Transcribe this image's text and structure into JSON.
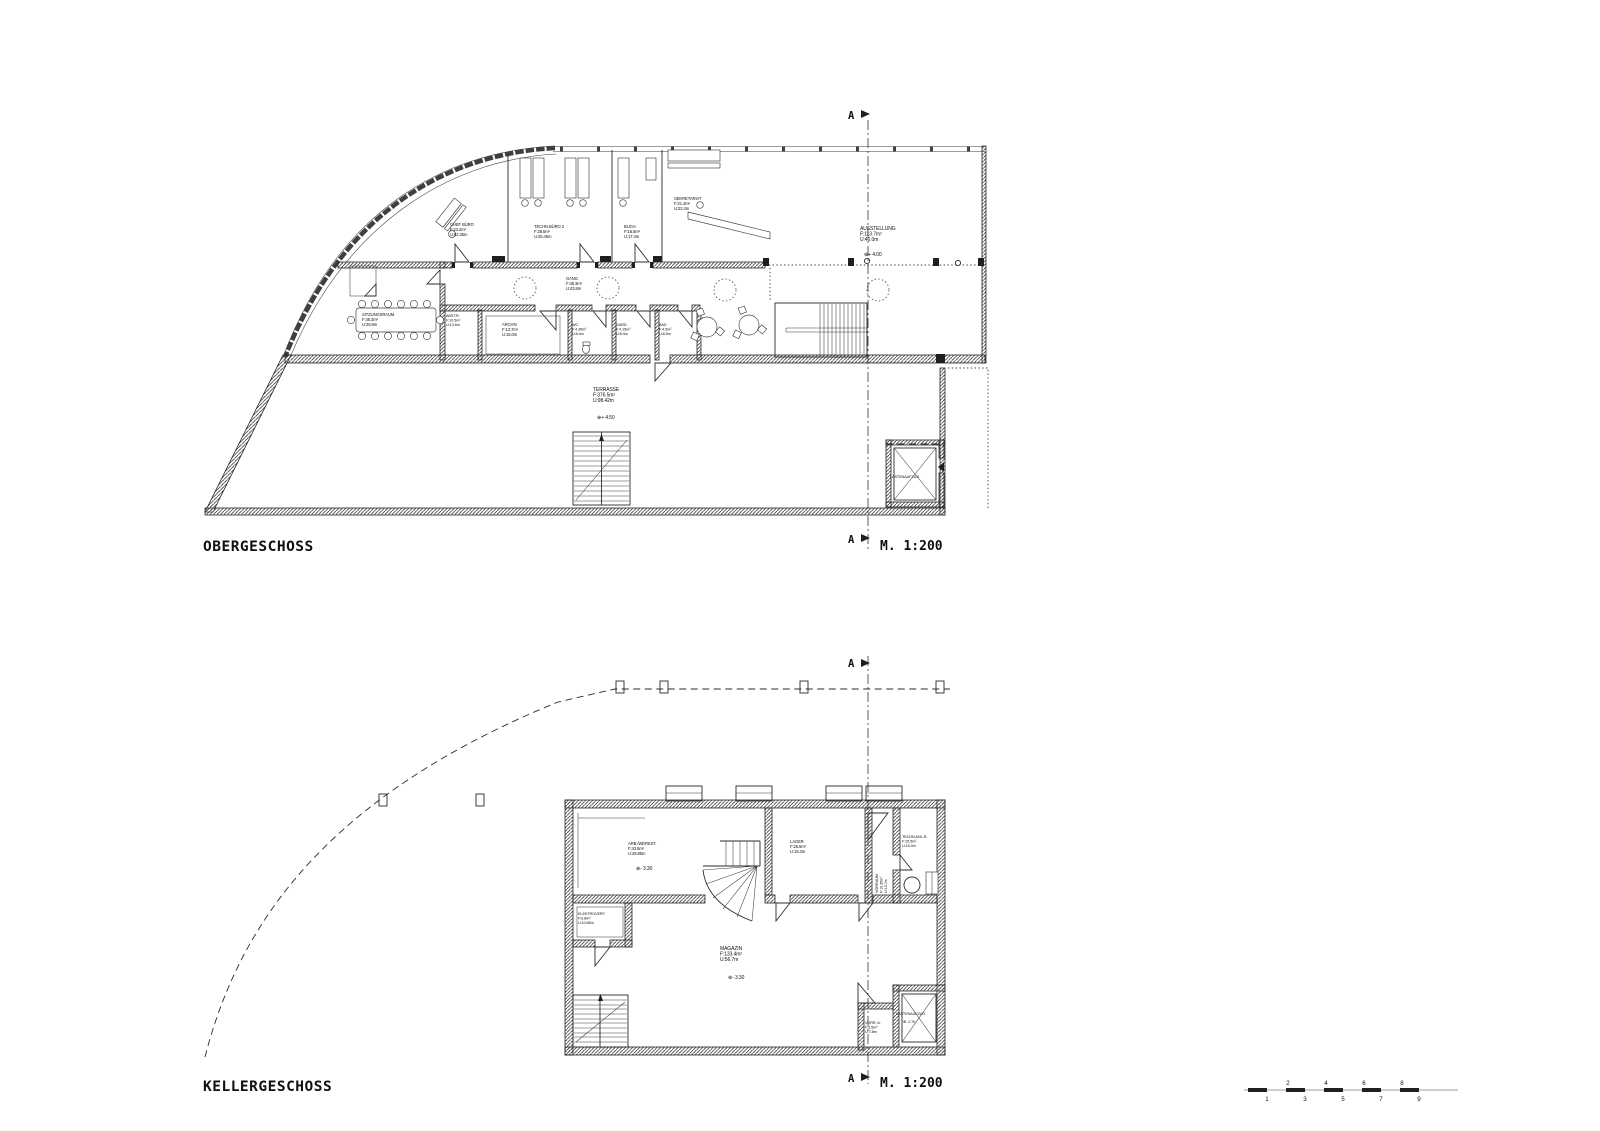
{
  "sheet": {
    "background": "#ffffff",
    "ink": "#1f1f1f"
  },
  "upper": {
    "title": "OBERGESCHOSS",
    "scale": "M. 1:200",
    "section": "A",
    "rooms": {
      "chef": {
        "name": "CHEF BÜRO",
        "a": "F:23.2m²",
        "u": "U:52.35m"
      },
      "techn": {
        "name": "TECHN.BÜRO 2",
        "a": "F:28.5m²",
        "u": "U:25.45m"
      },
      "buch": {
        "name": "BUCH.",
        "a": "F:16.5m²",
        "u": "U:17.4m"
      },
      "sekr": {
        "name": "SEKRETARIAT",
        "a": "F:21.4m²",
        "u": "U:22.4m"
      },
      "ausstellung": {
        "name": "AUSSTELLUNG",
        "a": "F:113.7m²",
        "u": "U:46.0m",
        "lvl": "⊕+ 4.00"
      },
      "gang": {
        "name": "GANG",
        "a": "F:48.3m²",
        "u": "U:43.8m"
      },
      "sitzung": {
        "name": "SITZUNGSRAUM",
        "a": "F:45.3m²",
        "u": "U:29.8m"
      },
      "abst": {
        "name": "ABST.R.",
        "a": "F:10.5m²",
        "u": "U:13.6m"
      },
      "archiv": {
        "name": "ARCHIV",
        "a": "F:13.7m²",
        "u": "U:15.0m"
      },
      "wc": {
        "name": "WC",
        "a": "F:4.35m²",
        "u": "U:8.4m"
      },
      "gard": {
        "name": "GARD.",
        "a": "F:4.15m²",
        "u": "U:8.4m"
      },
      "bad": {
        "name": "BAD",
        "a": "F:4.5m²",
        "u": "U:8.5m"
      },
      "terrasse": {
        "name": "TERRASSE",
        "a": "F:376.5m²",
        "u": "U:98.42m",
        "lvl": "⊕+ 4.50"
      },
      "lift": {
        "name": "LASTENAUFZUG"
      }
    }
  },
  "lower": {
    "title": "KELLERGESCHOSS",
    "scale": "M. 1:200",
    "section": "A",
    "rooms": {
      "arb": {
        "name": "ARB./WERKST.",
        "a": "F:43.5m²",
        "u": "U:28.85m",
        "lvl": "⊕- 3.30"
      },
      "lager": {
        "name": "LAGER",
        "a": "F:25.5m²",
        "u": "U:19.3m"
      },
      "vorraum": {
        "name": "VORRAUM",
        "a": "F:10.35m²",
        "u": "U:13.7m"
      },
      "techn": {
        "name": "TECHN.ANL.R.",
        "a": "F:15.5m²",
        "u": "U:15.4m"
      },
      "elektro": {
        "name": "ELEKTROVERT.",
        "a": "F:6.8m²",
        "u": "U:10.65m"
      },
      "magazin": {
        "name": "MAGAZIN",
        "a": "F:133.4m²",
        "u": "U:56.7m",
        "lvl": "⊕- 3.30"
      },
      "vorr_a": {
        "name": "VORR. A.",
        "a": "F:5.5m²",
        "u": "U:7.8m"
      },
      "lift": {
        "name": "LASTENAUFZUG",
        "lvl": "⊕- 2.70"
      }
    }
  },
  "scalebar": {
    "above": [
      "2",
      "4",
      "6",
      "8"
    ],
    "below": [
      "1",
      "3",
      "5",
      "7",
      "9"
    ]
  }
}
